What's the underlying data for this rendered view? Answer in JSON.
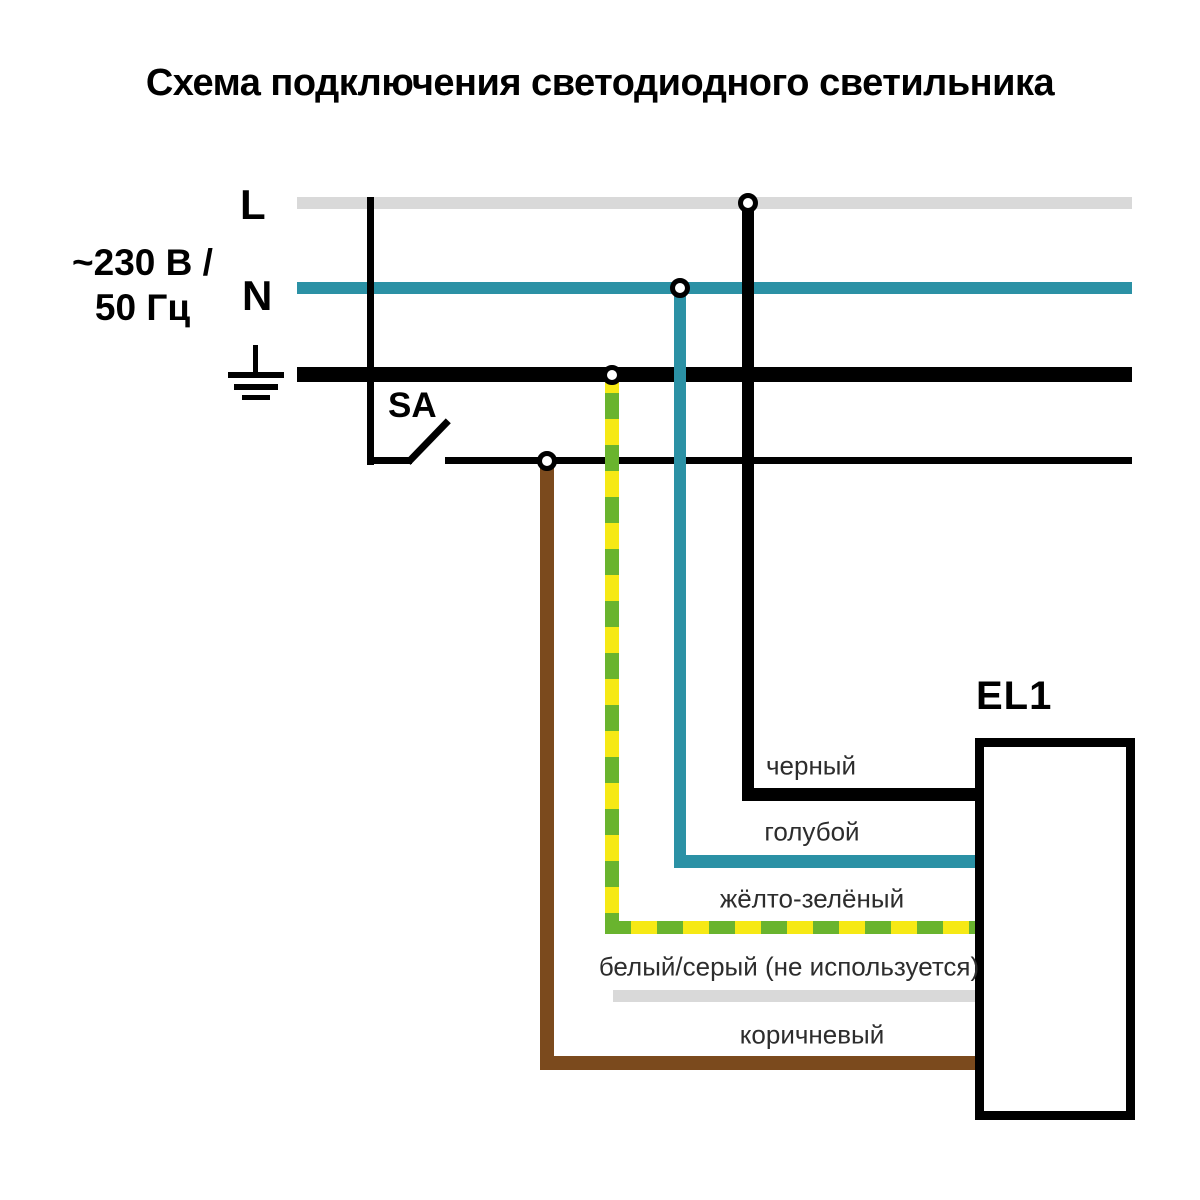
{
  "title": "Схема подключения светодиодного светильника",
  "power": {
    "voltage_line1": "~230 В /",
    "voltage_line2": "50 Гц",
    "line_label": "L",
    "neutral_label": "N"
  },
  "switch": {
    "label": "SA"
  },
  "luminaire": {
    "label": "EL1"
  },
  "wire_labels": {
    "black": "черный",
    "blue": "голубой",
    "yellow_green": "жёлто-зелёный",
    "white_gray": "белый/серый (не используется)",
    "brown": "коричневый"
  },
  "colors": {
    "line_gray": "#d9d9d9",
    "neutral_teal": "#2b91a5",
    "wire_black": "#000000",
    "pe_yellow": "#f6e915",
    "pe_green": "#69b42e",
    "wire_brown": "#7b4a1d",
    "label_text": "#2d2d2d"
  }
}
